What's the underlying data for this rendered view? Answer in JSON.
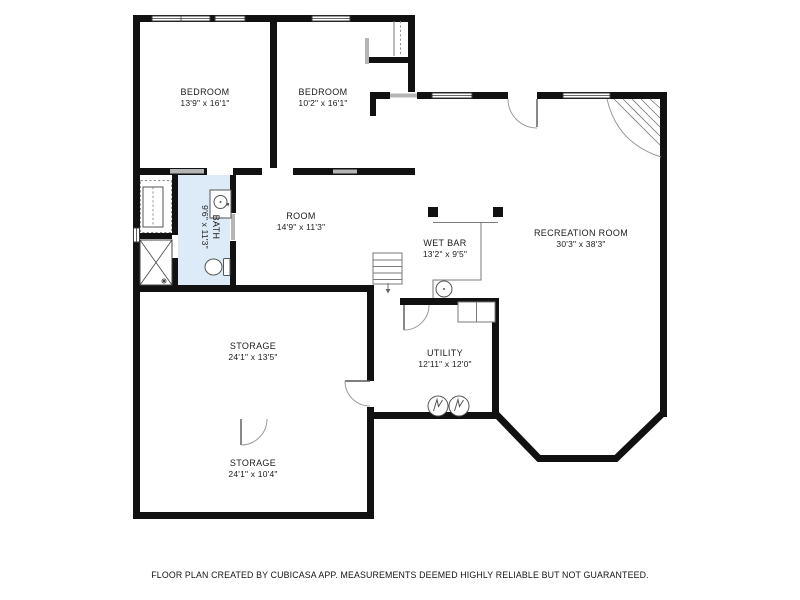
{
  "page": {
    "width": 800,
    "height": 600,
    "background": "#ffffff"
  },
  "palette": {
    "wall": "#111111",
    "bath_fill": "#dcebf7",
    "sill": "#b5b5b5",
    "fixture_line": "#555555",
    "counter_line": "#7a7a7a",
    "window_frame": "#3a3a3a",
    "text": "#1c1c1c",
    "bg": "#ffffff"
  },
  "rooms": [
    {
      "id": "bedroom-1",
      "name": "BEDROOM",
      "dims": "13'9\" x 16'1\""
    },
    {
      "id": "bedroom-2",
      "name": "BEDROOM",
      "dims": "10'2\" x 16'1\""
    },
    {
      "id": "room",
      "name": "ROOM",
      "dims": "14'9\" x 11'3\""
    },
    {
      "id": "bath",
      "name": "BATH",
      "dims": "9'6\" x 11'3\""
    },
    {
      "id": "wet-bar",
      "name": "WET BAR",
      "dims": "13'2\" x 9'5\""
    },
    {
      "id": "recreation-room",
      "name": "RECREATION ROOM",
      "dims": "30'3\" x 38'3\""
    },
    {
      "id": "storage-1",
      "name": "STORAGE",
      "dims": "24'1\" x 13'5\""
    },
    {
      "id": "utility",
      "name": "UTILITY",
      "dims": "12'11\" x 12'0\""
    },
    {
      "id": "storage-2",
      "name": "STORAGE",
      "dims": "24'1\" x 10'4\""
    }
  ],
  "icons": {
    "sink": "sink-icon",
    "toilet": "toilet-icon",
    "shower": "shower-icon",
    "water_heater": "water-heater-icon",
    "stairs": "stairs-icon",
    "closet": "closet-icon"
  },
  "footer": {
    "disclaimer": "FLOOR PLAN CREATED BY CUBICASA APP. MEASUREMENTS DEEMED HIGHLY RELIABLE BUT NOT GUARANTEED."
  }
}
